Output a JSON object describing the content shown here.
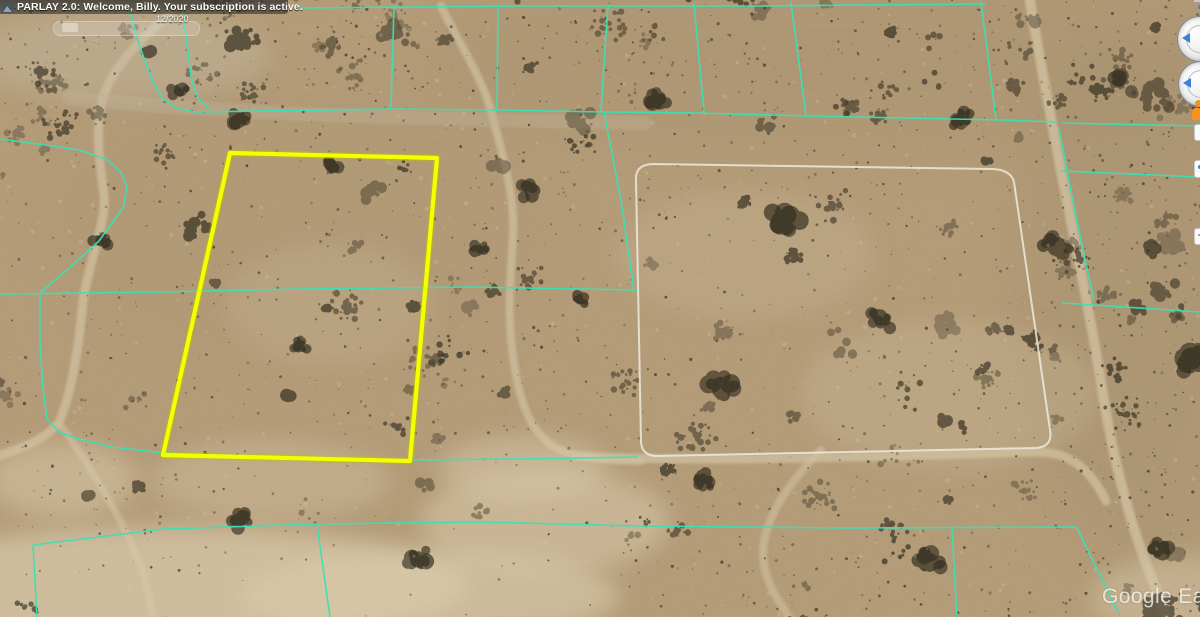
{
  "header": {
    "icon": "parlay-app-icon",
    "title": "PARLAY 2.0: Welcome, Billy. Your subscription is active."
  },
  "time_slider": {
    "label": "12/2020"
  },
  "watermark": {
    "text": "Google Ear"
  },
  "controls": {
    "look_ring": "look-joystick",
    "move_ring": "move-joystick",
    "pegman": "street-view-pegman",
    "zoom": "zoom-slider"
  },
  "map": {
    "colors": {
      "sand_base": "#b59c78",
      "sand_light": "#d3c3a2",
      "wash": "#dccdae",
      "cyan_line": "#3be0b4",
      "white_line": "#eceadf",
      "yellow_line": "#f4ff00",
      "yellow_under": "#b9c400",
      "bush_palette": [
        "#332e20",
        "#423a28",
        "#2b2718",
        "#4d4431"
      ],
      "speck_light": "#d8c7a4"
    },
    "yellow_parcel": {
      "points": [
        [
          230,
          153
        ],
        [
          437,
          158
        ],
        [
          410,
          461
        ],
        [
          163,
          455
        ]
      ],
      "width": 4.2
    },
    "white_parcel": {
      "path": "M 652 164 L 993 169 Q 1011 170 1014 182 L 1050 430 Q 1053 446 1037 448 L 657 456 Q 642 456 641 442 L 636 180 Q 635 165 652 164 Z",
      "width": 2
    },
    "cyan_lines": {
      "width": 1.6,
      "polylines": [
        [
          [
            130,
            12
          ],
          [
            137,
            38
          ],
          [
            146,
            64
          ],
          [
            154,
            84
          ],
          [
            163,
            99
          ],
          [
            176,
            108
          ],
          [
            195,
            112
          ],
          [
            392,
            109
          ],
          [
            497,
            110
          ],
          [
            604,
            112
          ],
          [
            697,
            113
          ],
          [
            806,
            116
          ],
          [
            905,
            118
          ],
          [
            1000,
            120
          ],
          [
            1056,
            122
          ]
        ],
        [
          [
            1063,
            123
          ],
          [
            1200,
            126
          ]
        ],
        [
          [
            183,
            13
          ],
          [
            187,
            45
          ],
          [
            191,
            76
          ],
          [
            198,
            99
          ],
          [
            210,
            109
          ]
        ],
        [
          [
            0,
            139
          ],
          [
            45,
            145
          ],
          [
            79,
            150
          ],
          [
            106,
            159
          ],
          [
            121,
            172
          ],
          [
            127,
            187
          ],
          [
            123,
            208
          ],
          [
            99,
            241
          ],
          [
            68,
            269
          ],
          [
            41,
            292
          ]
        ],
        [
          [
            0,
            294
          ],
          [
            160,
            292
          ],
          [
            300,
            289
          ],
          [
            470,
            287
          ],
          [
            636,
            290
          ]
        ],
        [
          [
            1063,
            303
          ],
          [
            1200,
            312
          ]
        ],
        [
          [
            40,
            295
          ],
          [
            40,
            342
          ],
          [
            43,
            388
          ],
          [
            47,
            419
          ],
          [
            59,
            432
          ],
          [
            79,
            439
          ],
          [
            112,
            447
          ],
          [
            163,
            453
          ],
          [
            300,
            458
          ],
          [
            410,
            460
          ],
          [
            520,
            459
          ],
          [
            637,
            457
          ]
        ],
        [
          [
            394,
            6
          ],
          [
            391,
            108
          ]
        ],
        [
          [
            498,
            5
          ],
          [
            497,
            110
          ]
        ],
        [
          [
            608,
            5
          ],
          [
            601,
            111
          ]
        ],
        [
          [
            604,
            112
          ],
          [
            621,
            200
          ],
          [
            634,
            291
          ]
        ],
        [
          [
            694,
            4
          ],
          [
            704,
            112
          ]
        ],
        [
          [
            791,
            3
          ],
          [
            806,
            115
          ]
        ],
        [
          [
            981,
            2
          ],
          [
            996,
            119
          ]
        ],
        [
          [
            300,
            8
          ],
          [
            520,
            6
          ],
          [
            760,
            6
          ],
          [
            985,
            4
          ]
        ],
        [
          [
            1059,
            129
          ],
          [
            1077,
            222
          ],
          [
            1094,
            300
          ]
        ],
        [
          [
            1061,
            171
          ],
          [
            1200,
            177
          ]
        ],
        [
          [
            33,
            545
          ],
          [
            163,
            529
          ],
          [
            317,
            524
          ],
          [
            480,
            522
          ],
          [
            640,
            526
          ],
          [
            850,
            528
          ],
          [
            1076,
            527
          ]
        ],
        [
          [
            317,
            525
          ],
          [
            330,
            617
          ]
        ],
        [
          [
            33,
            546
          ],
          [
            37,
            617
          ]
        ],
        [
          [
            952,
            529
          ],
          [
            957,
            617
          ]
        ],
        [
          [
            1077,
            528
          ],
          [
            1118,
            612
          ]
        ]
      ]
    },
    "roads": [
      {
        "d": "M170,14 C140,40 108,70 101,106 C95,136 101,170 104,196 C107,221 89,261 83,301 C79,346 71,396 59,422 C46,440 18,450 -5,457",
        "w": 9,
        "o": 0.75
      },
      {
        "d": "M60,424 C86,460 121,516 141,566 C149,591 151,606 153,617",
        "w": 7,
        "o": 0.6
      },
      {
        "d": "M441,6 C460,45 484,80 493,118 C504,160 515,196 513,236 C510,286 506,321 516,376 C523,411 533,431 551,445 C566,456 601,461 641,461",
        "w": 8,
        "o": 0.7
      },
      {
        "d": "M1029,-4 C1040,60 1053,131 1067,201 C1081,271 1093,331 1104,401 C1113,456 1129,521 1149,571 C1157,593 1163,606 1167,617",
        "w": 10,
        "o": 0.8
      },
      {
        "d": "M576,456 C700,463 900,456 1030,452 C1072,450 1091,471 1106,501",
        "w": 9,
        "o": 0.75
      },
      {
        "d": "M821,450 C796,476 771,506 764,541 C759,571 773,593 789,617",
        "w": 8,
        "o": 0.6
      },
      {
        "d": "M70,98 C250,116 450,119 645,123",
        "w": 14,
        "o": 0.38,
        "c": "#c2b69c"
      }
    ],
    "washes": [
      {
        "cx": 850,
        "cy": 60,
        "rx": 420,
        "ry": 95,
        "o": 0.16,
        "fill": "#96805f"
      },
      {
        "cx": 1140,
        "cy": 300,
        "rx": 130,
        "ry": 260,
        "o": 0.18,
        "fill": "#93805f"
      },
      {
        "cx": 300,
        "cy": 220,
        "rx": 260,
        "ry": 140,
        "o": 0.1,
        "fill": "#a18a67"
      },
      {
        "cx": 170,
        "cy": 585,
        "rx": 300,
        "ry": 58,
        "o": 0.72
      },
      {
        "cx": 430,
        "cy": 596,
        "rx": 190,
        "ry": 46,
        "o": 0.65
      },
      {
        "cx": 545,
        "cy": 522,
        "rx": 125,
        "ry": 52,
        "o": 0.55
      },
      {
        "cx": 523,
        "cy": 468,
        "rx": 85,
        "ry": 32,
        "o": 0.5
      },
      {
        "cx": 120,
        "cy": 55,
        "rx": 150,
        "ry": 45,
        "o": 0.4,
        "fill": "#c8bda7"
      },
      {
        "cx": 1185,
        "cy": 598,
        "rx": 95,
        "ry": 42,
        "o": 0.45
      },
      {
        "cx": 62,
        "cy": 480,
        "rx": 75,
        "ry": 38,
        "o": 0.5
      },
      {
        "cx": 950,
        "cy": 395,
        "rx": 150,
        "ry": 75,
        "o": 0.22
      },
      {
        "cx": 745,
        "cy": 255,
        "rx": 130,
        "ry": 65,
        "o": 0.18
      },
      {
        "cx": 330,
        "cy": 305,
        "rx": 105,
        "ry": 62,
        "o": 0.18
      },
      {
        "cx": 270,
        "cy": 480,
        "rx": 120,
        "ry": 40,
        "o": 0.35
      }
    ],
    "bushes": {
      "seed": 7,
      "clusters": 260,
      "singles": 2600,
      "specks": 380,
      "big": [
        {
          "x": 785,
          "y": 222,
          "r": 20
        },
        {
          "x": 720,
          "y": 385,
          "r": 16
        },
        {
          "x": 1190,
          "y": 360,
          "r": 18
        },
        {
          "x": 930,
          "y": 560,
          "r": 14
        },
        {
          "x": 530,
          "y": 190,
          "r": 12
        },
        {
          "x": 300,
          "y": 345,
          "r": 10
        },
        {
          "x": 880,
          "y": 320,
          "r": 12
        },
        {
          "x": 1050,
          "y": 240,
          "r": 14
        },
        {
          "x": 660,
          "y": 100,
          "r": 13
        },
        {
          "x": 420,
          "y": 560,
          "r": 15
        },
        {
          "x": 240,
          "y": 520,
          "r": 12
        },
        {
          "x": 960,
          "y": 120,
          "r": 12
        },
        {
          "x": 330,
          "y": 165,
          "r": 11
        },
        {
          "x": 700,
          "y": 480,
          "r": 12
        },
        {
          "x": 100,
          "y": 240,
          "r": 10
        },
        {
          "x": 580,
          "y": 300,
          "r": 9
        },
        {
          "x": 180,
          "y": 90,
          "r": 11
        },
        {
          "x": 1120,
          "y": 80,
          "r": 13
        },
        {
          "x": 1160,
          "y": 550,
          "r": 14
        },
        {
          "x": 480,
          "y": 250,
          "r": 9
        },
        {
          "x": 240,
          "y": 120,
          "r": 13
        }
      ]
    }
  }
}
